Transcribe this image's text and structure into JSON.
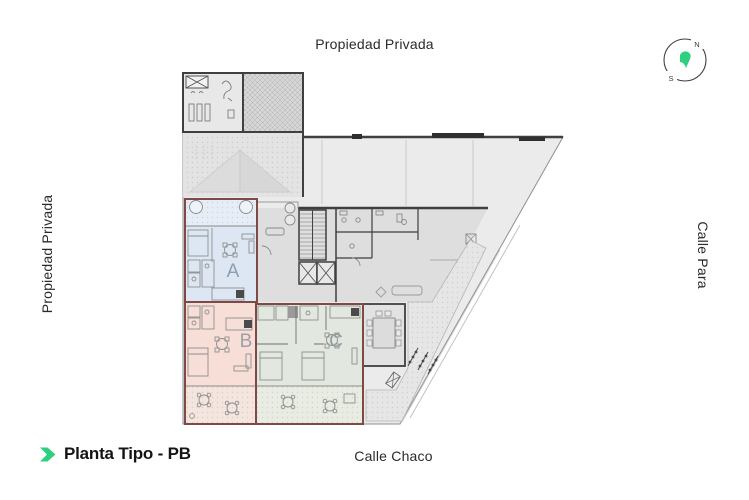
{
  "labels": {
    "top": "Propiedad Privada",
    "left": "Propiedad Privada",
    "right": "Calle Para",
    "bottom": "Calle Chaco"
  },
  "footer": {
    "title": "Planta Tipo - PB"
  },
  "compass": {
    "north": "N",
    "south": "S"
  },
  "colors": {
    "accent": "#2ed07f",
    "wall": "#3f3f3f",
    "lot_fill": "#ebebeb",
    "building_fill": "#dedede"
  },
  "plan": {
    "name": "Planta Tipo - PB floor plan",
    "outline_color": "#7d4a45",
    "units": [
      {
        "label": "A",
        "fill": "#dde7f3",
        "patio_fill": "#e6edf6",
        "label_color": "#8c9eb0"
      },
      {
        "label": "B",
        "fill": "#f7ded6",
        "patio_fill": "#f4e5df",
        "label_color": "#9d9fa8"
      },
      {
        "label": "C",
        "fill": "#e2e8df",
        "patio_fill": "#e8ece3",
        "label_color": "#8fa0a5"
      }
    ]
  }
}
